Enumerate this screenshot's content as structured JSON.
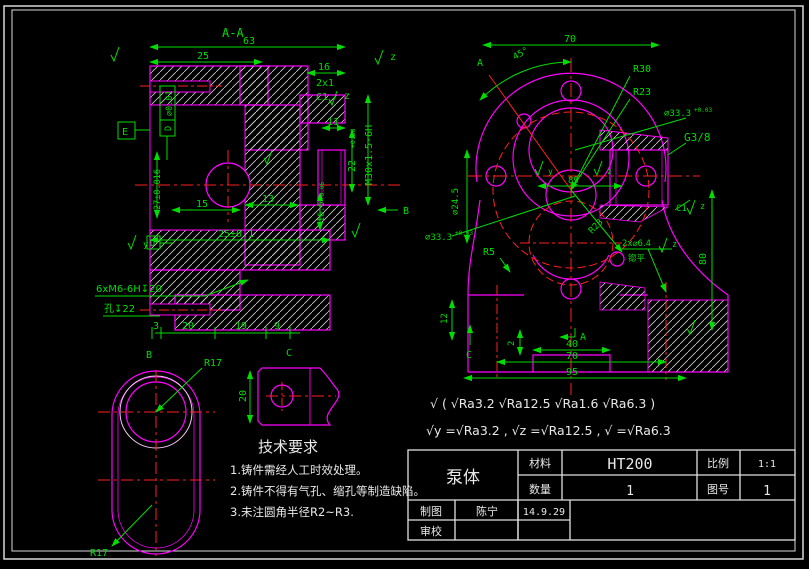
{
  "colors": {
    "dim": "#00dd00",
    "outline": "#ff00ff",
    "center": "#ff2020",
    "white": "#e8e8e8"
  },
  "section_view": {
    "title": "A-A",
    "d63": "63",
    "d25": "25",
    "d16": "16",
    "d2x1": "2x1",
    "c1": "C1",
    "d11": "11",
    "d22": "22",
    "d22_tol": "+0.28",
    "thread": "M30x1.5-6H",
    "fcf": "⌀0.01",
    "fcf_datum": "D",
    "datum_e": "E",
    "datum_d": "D",
    "rough_y": "y",
    "rough_z": "z",
    "d27": "27±0.016",
    "d15": "15",
    "d13": "13",
    "d25t": "25±0.1",
    "d165": "16.5",
    "d165_tol": "+0.06",
    "tap_note": "6xM6-6H↧20",
    "tap_note2": "孔↧22",
    "d3": "3",
    "d20": "20",
    "d19": "19",
    "d9": "9",
    "dir_b": "B"
  },
  "front_view": {
    "d70_top": "70",
    "a45": "45°",
    "sec_a": "A",
    "sec_a_b": "A",
    "r30": "R30",
    "r23": "R23",
    "r23_low": "R23",
    "d333_r": "⌀33.3",
    "d333_r_tol": "+0.03",
    "d333_l": "⌀33.3",
    "d333_l_tol": "+0.03",
    "g38": "G3/8",
    "d245": "⌀24.5",
    "d89": "89",
    "r5": "R5",
    "d12": "12",
    "d2": "2",
    "d40": "40",
    "d70_b": "70",
    "d95": "95",
    "d80": "80",
    "cb_holes": "2x⌀6.4",
    "cb_note": "锪平",
    "c1": "C1",
    "rough_z": "z",
    "rough_y": "y",
    "dir_c": "C"
  },
  "view_b": {
    "label": "B",
    "r17_top": "R17",
    "r17_bot": "R17"
  },
  "view_c": {
    "label": "C",
    "d20": "20"
  },
  "tech_req": {
    "title": "技术要求",
    "items": [
      "1.铸件需经人工时效处理。",
      "2.铸件不得有气孔、缩孔等制造缺陷。",
      "3.未注圆角半径R2~R3."
    ]
  },
  "roughness_note": {
    "line1": "√ ( √Ra3.2  √Ra12.5  √Ra1.6  √Ra6.3 )",
    "line2": "√y =√Ra3.2 ,  √z =√Ra12.5 ,  √ =√Ra6.3"
  },
  "title_block": {
    "part": "泵体",
    "material_label": "材料",
    "material": "HT200",
    "scale_label": "比例",
    "scale": "1:1",
    "qty_label": "数量",
    "qty": "1",
    "no_label": "图号",
    "no": "1",
    "draft_label": "制图",
    "drafter": "陈宁",
    "date": "14.9.29",
    "check_label": "审校"
  }
}
